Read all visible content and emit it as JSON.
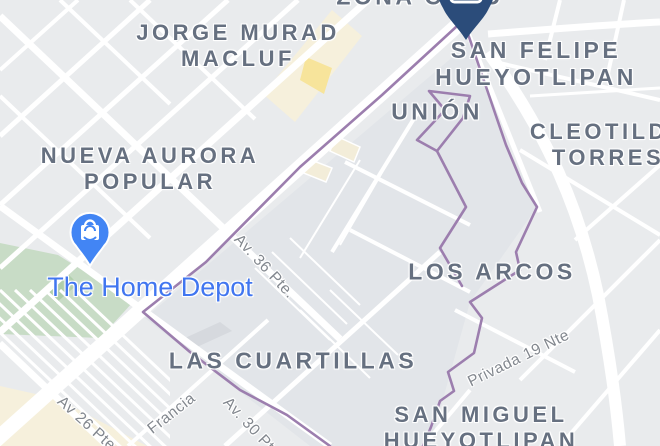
{
  "map": {
    "attribution_visible": false,
    "colors": {
      "background": "#E9EBED",
      "block_shade": "#E2E5E9",
      "road": "#FFFFFF",
      "park_green": "#C8DCC6",
      "park_green_dark": "#AFCDAA",
      "commercial_cream": "#F6F0DC",
      "commercial_yellow": "#F7E49B",
      "boundary_purple": "#9C7EAE",
      "area_label_gray": "#667080",
      "street_label_gray": "#82878E",
      "poi_blue": "#4176F0",
      "destination_pin_navy": "#2B4C7A",
      "shop_pin_blue": "#4285F4"
    },
    "area_labels": [
      {
        "id": "zona-capu",
        "lines": [
          "ZONA CAPU"
        ],
        "x": 420,
        "y": -3,
        "fs": 23
      },
      {
        "id": "jorge-murad-macluf",
        "lines": [
          "JORGE MURAD",
          "MACLUF"
        ],
        "x": 238,
        "y": 46,
        "fs": 22
      },
      {
        "id": "san-felipe-hueyotlipan",
        "lines": [
          "SAN FELIPE",
          "HUEYOTLIPAN"
        ],
        "x": 536,
        "y": 64,
        "fs": 23
      },
      {
        "id": "union",
        "lines": [
          "UNIÓN"
        ],
        "x": 437,
        "y": 112,
        "fs": 23
      },
      {
        "id": "cleotilde-torres",
        "lines": [
          "CLEOTILDE",
          "TORRES"
        ],
        "x": 608,
        "y": 145,
        "fs": 22
      },
      {
        "id": "nueva-aurora-popular",
        "lines": [
          "NUEVA AURORA",
          "POPULAR"
        ],
        "x": 150,
        "y": 169,
        "fs": 22
      },
      {
        "id": "los-arcos",
        "lines": [
          "LOS ARCOS"
        ],
        "x": 492,
        "y": 272,
        "fs": 23
      },
      {
        "id": "las-cuartillas",
        "lines": [
          "LAS CUARTILLAS"
        ],
        "x": 293,
        "y": 361,
        "fs": 23
      },
      {
        "id": "san-miguel-hueyotlipan",
        "lines": [
          "SAN MIGUEL",
          "HUEYOTLIPAN"
        ],
        "x": 481,
        "y": 428,
        "fs": 22
      }
    ],
    "street_labels": [
      {
        "id": "av-36-pte",
        "text": "Av. 36 Pte.",
        "x": 264,
        "y": 267,
        "rot": 47
      },
      {
        "id": "av-26-pte",
        "text": "Av 26 Pte",
        "x": 86,
        "y": 424,
        "rot": 42
      },
      {
        "id": "av-30-pte",
        "text": "Av. 30 Pte.",
        "x": 253,
        "y": 430,
        "rot": 47
      },
      {
        "id": "francia",
        "text": "Francia",
        "x": 172,
        "y": 414,
        "rot": -38
      },
      {
        "id": "privada-19-nte",
        "text": "Privada 19 Nte",
        "x": 519,
        "y": 359,
        "rot": -26
      }
    ],
    "poi_labels": [
      {
        "id": "the-home-depot",
        "text": "The Home Depot",
        "x": 150,
        "y": 288,
        "fs": 27,
        "color": "#4176F0"
      }
    ],
    "markers": [
      {
        "id": "destination-pin",
        "icon": "place-pin-icon",
        "color": "#2B4C7A",
        "x": 466,
        "y": 40
      },
      {
        "id": "home-depot-pin",
        "icon": "shopping-bag-pin-icon",
        "color": "#4285F4",
        "x": 90,
        "y": 266
      }
    ]
  }
}
